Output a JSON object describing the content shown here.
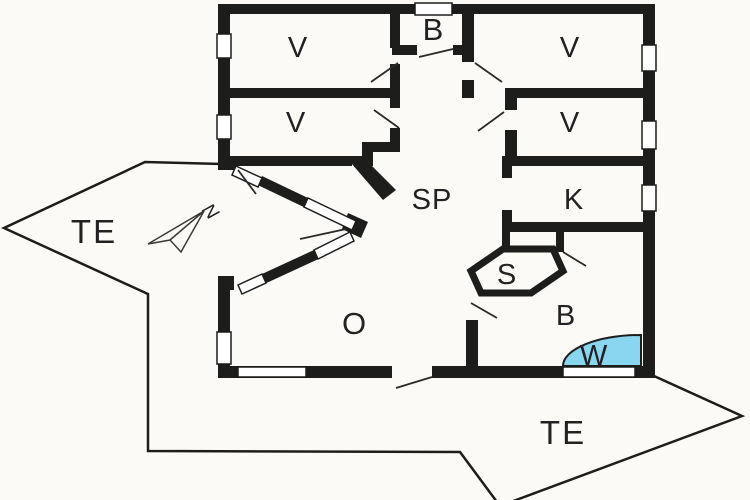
{
  "meta": {
    "type": "floor-plan",
    "description": "holiday house floor plan with terraces"
  },
  "colors": {
    "background": "#fbfaf7",
    "wall": "#1d1d1b",
    "water": "#8ad5f0",
    "text": "#222222"
  },
  "labels": {
    "bedroom_nw": "V",
    "bedroom_w": "V",
    "bath_small": "B",
    "bedroom_ne": "V",
    "bedroom_e": "V",
    "hall": "SP",
    "kitchen": "K",
    "sauna": "S",
    "bathroom": "B",
    "whirlpool": "W",
    "living": "O",
    "terrace_west": "TE",
    "terrace_south": "TE",
    "compass": "N"
  }
}
